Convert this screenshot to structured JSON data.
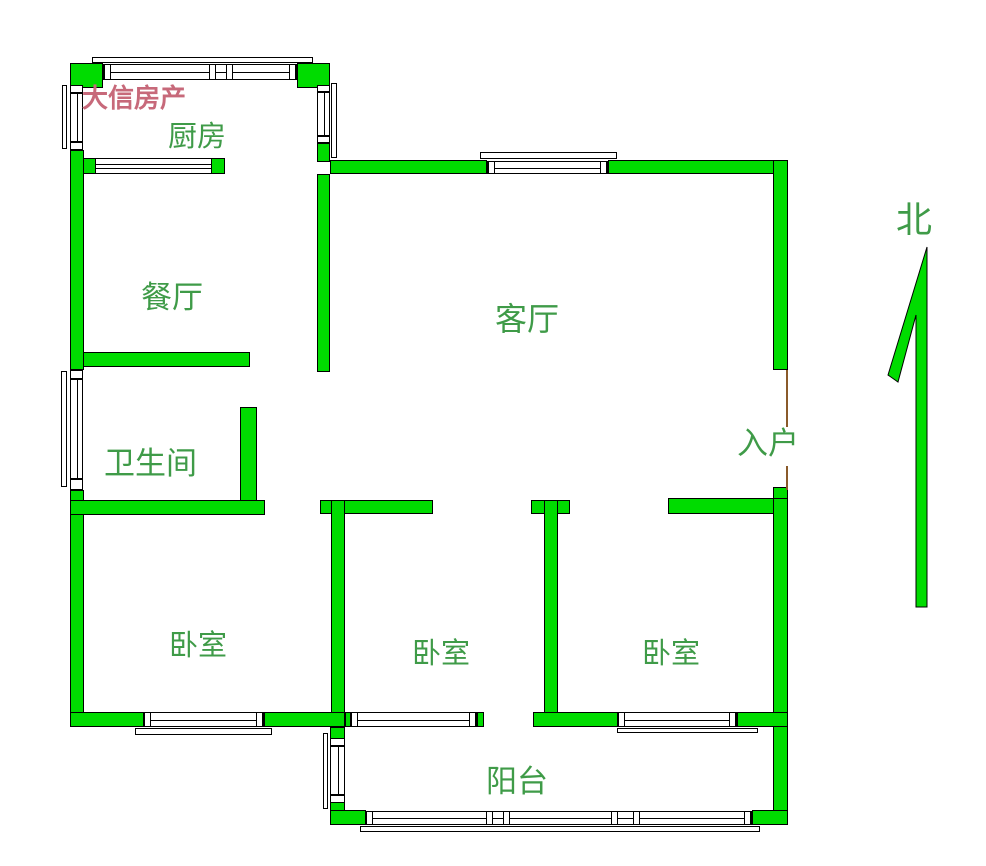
{
  "watermark": "大信房产",
  "compass": {
    "label": "北"
  },
  "rooms": {
    "kitchen": {
      "label": "厨房"
    },
    "dining": {
      "label": "餐厅"
    },
    "living": {
      "label": "客厅"
    },
    "bathroom": {
      "label": "卫生间"
    },
    "entry": {
      "label": "入户"
    },
    "bedroom_left": {
      "label": "卧室"
    },
    "bedroom_middle": {
      "label": "卧室"
    },
    "bedroom_right": {
      "label": "卧室"
    },
    "balcony": {
      "label": "阳台"
    }
  },
  "colors": {
    "wall": "#00dc00",
    "outline": "#000000",
    "label": "#3f9b48",
    "watermark": "#c7697a",
    "door_line": "#8a5a2a",
    "background": "#ffffff"
  }
}
